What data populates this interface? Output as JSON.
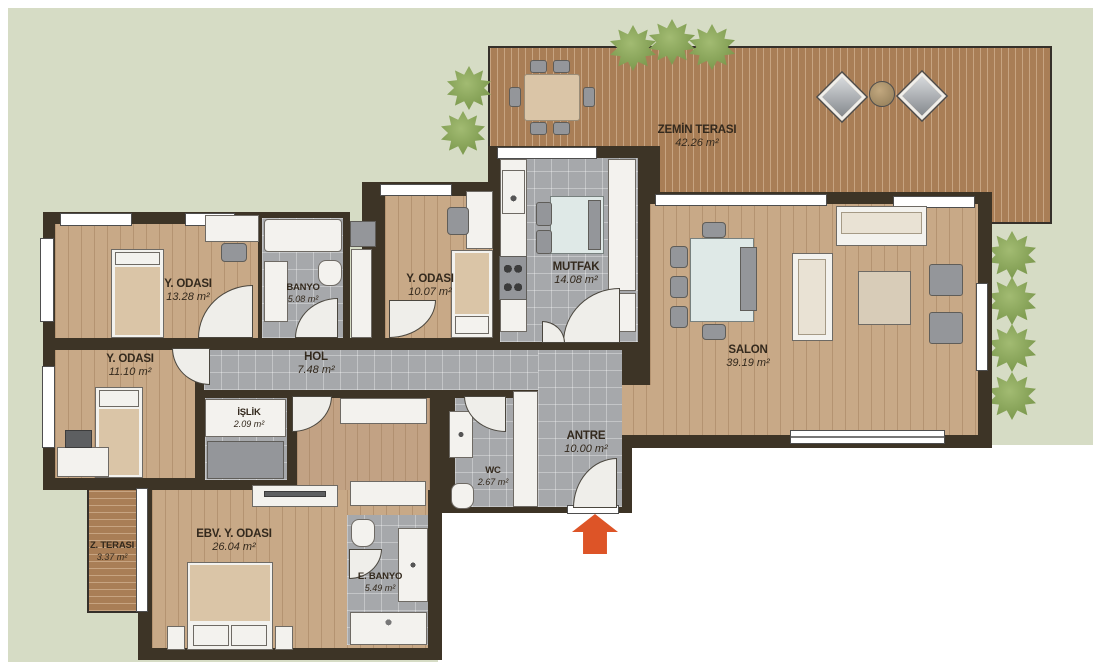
{
  "rooms": {
    "zemin_terasi": {
      "name": "ZEMİN TERASI",
      "area": "42.26 m²"
    },
    "y_odasi_1": {
      "name": "Y. ODASI",
      "area": "13.28 m²"
    },
    "banyo": {
      "name": "BANYO",
      "area": "5.08 m²"
    },
    "y_odasi_2": {
      "name": "Y. ODASI",
      "area": "10.07 m²"
    },
    "mutfak": {
      "name": "MUTFAK",
      "area": "14.08 m²"
    },
    "salon": {
      "name": "SALON",
      "area": "39.19 m²"
    },
    "y_odasi_3": {
      "name": "Y. ODASI",
      "area": "11.10 m²"
    },
    "hol": {
      "name": "HOL",
      "area": "7.48 m²"
    },
    "islik": {
      "name": "İŞLİK",
      "area": "2.09 m²"
    },
    "wc": {
      "name": "WC",
      "area": "2.67 m²"
    },
    "antre": {
      "name": "ANTRE",
      "area": "10.00 m²"
    },
    "ebv_y_odasi": {
      "name": "EBV. Y. ODASI",
      "area": "26.04 m²"
    },
    "e_banyo": {
      "name": "E. BANYO",
      "area": "5.49 m²"
    },
    "z_terasi": {
      "name": "Z. TERASI",
      "area": "3.37 m²"
    }
  },
  "colors": {
    "background": "#ffffff",
    "garden": "#d6dcc5",
    "deck": "#a97e56",
    "wall": "#3d3426",
    "wood_floor": "#c8a987",
    "tile_floor": "#a6a8ab",
    "label_text": "#33291d",
    "entry_arrow": "#dd5427",
    "plant": "#86a256"
  }
}
